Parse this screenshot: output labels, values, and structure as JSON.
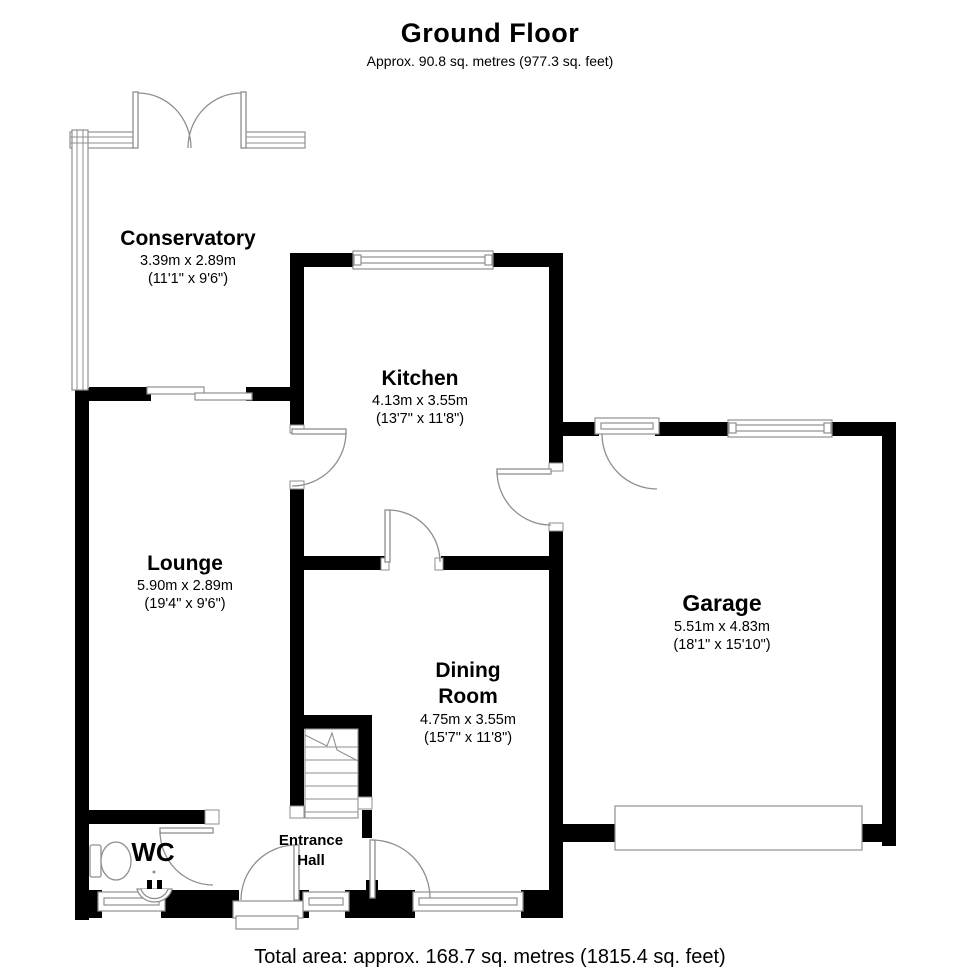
{
  "header": {
    "title": "Ground Floor",
    "subtitle": "Approx. 90.8 sq. metres (977.3 sq. feet)"
  },
  "footer": {
    "total_area": "Total area: approx. 168.7 sq. metres (1815.4 sq. feet)"
  },
  "rooms": [
    {
      "id": "conservatory",
      "name": "Conservatory",
      "dims_m": "3.39m x 2.89m",
      "dims_ft": "(11'1\" x 9'6\")"
    },
    {
      "id": "kitchen",
      "name": "Kitchen",
      "dims_m": "4.13m x 3.55m",
      "dims_ft": "(13'7\" x 11'8\")"
    },
    {
      "id": "lounge",
      "name": "Lounge",
      "dims_m": "5.90m x 2.89m",
      "dims_ft": "(19'4\" x 9'6\")"
    },
    {
      "id": "garage",
      "name": "Garage",
      "dims_m": "5.51m x 4.83m",
      "dims_ft": "(18'1\" x 15'10\")"
    },
    {
      "id": "dining-room",
      "name": "Dining Room",
      "dims_m": "4.75m x 3.55m",
      "dims_ft": "(15'7\" x 11'8\")"
    },
    {
      "id": "wc",
      "name": "WC"
    },
    {
      "id": "entrance-hall",
      "name": "Entrance Hall"
    }
  ],
  "colors": {
    "wall": "#000000",
    "thin_line": "#8f8f8f",
    "background": "#ffffff",
    "text": "#000000"
  }
}
